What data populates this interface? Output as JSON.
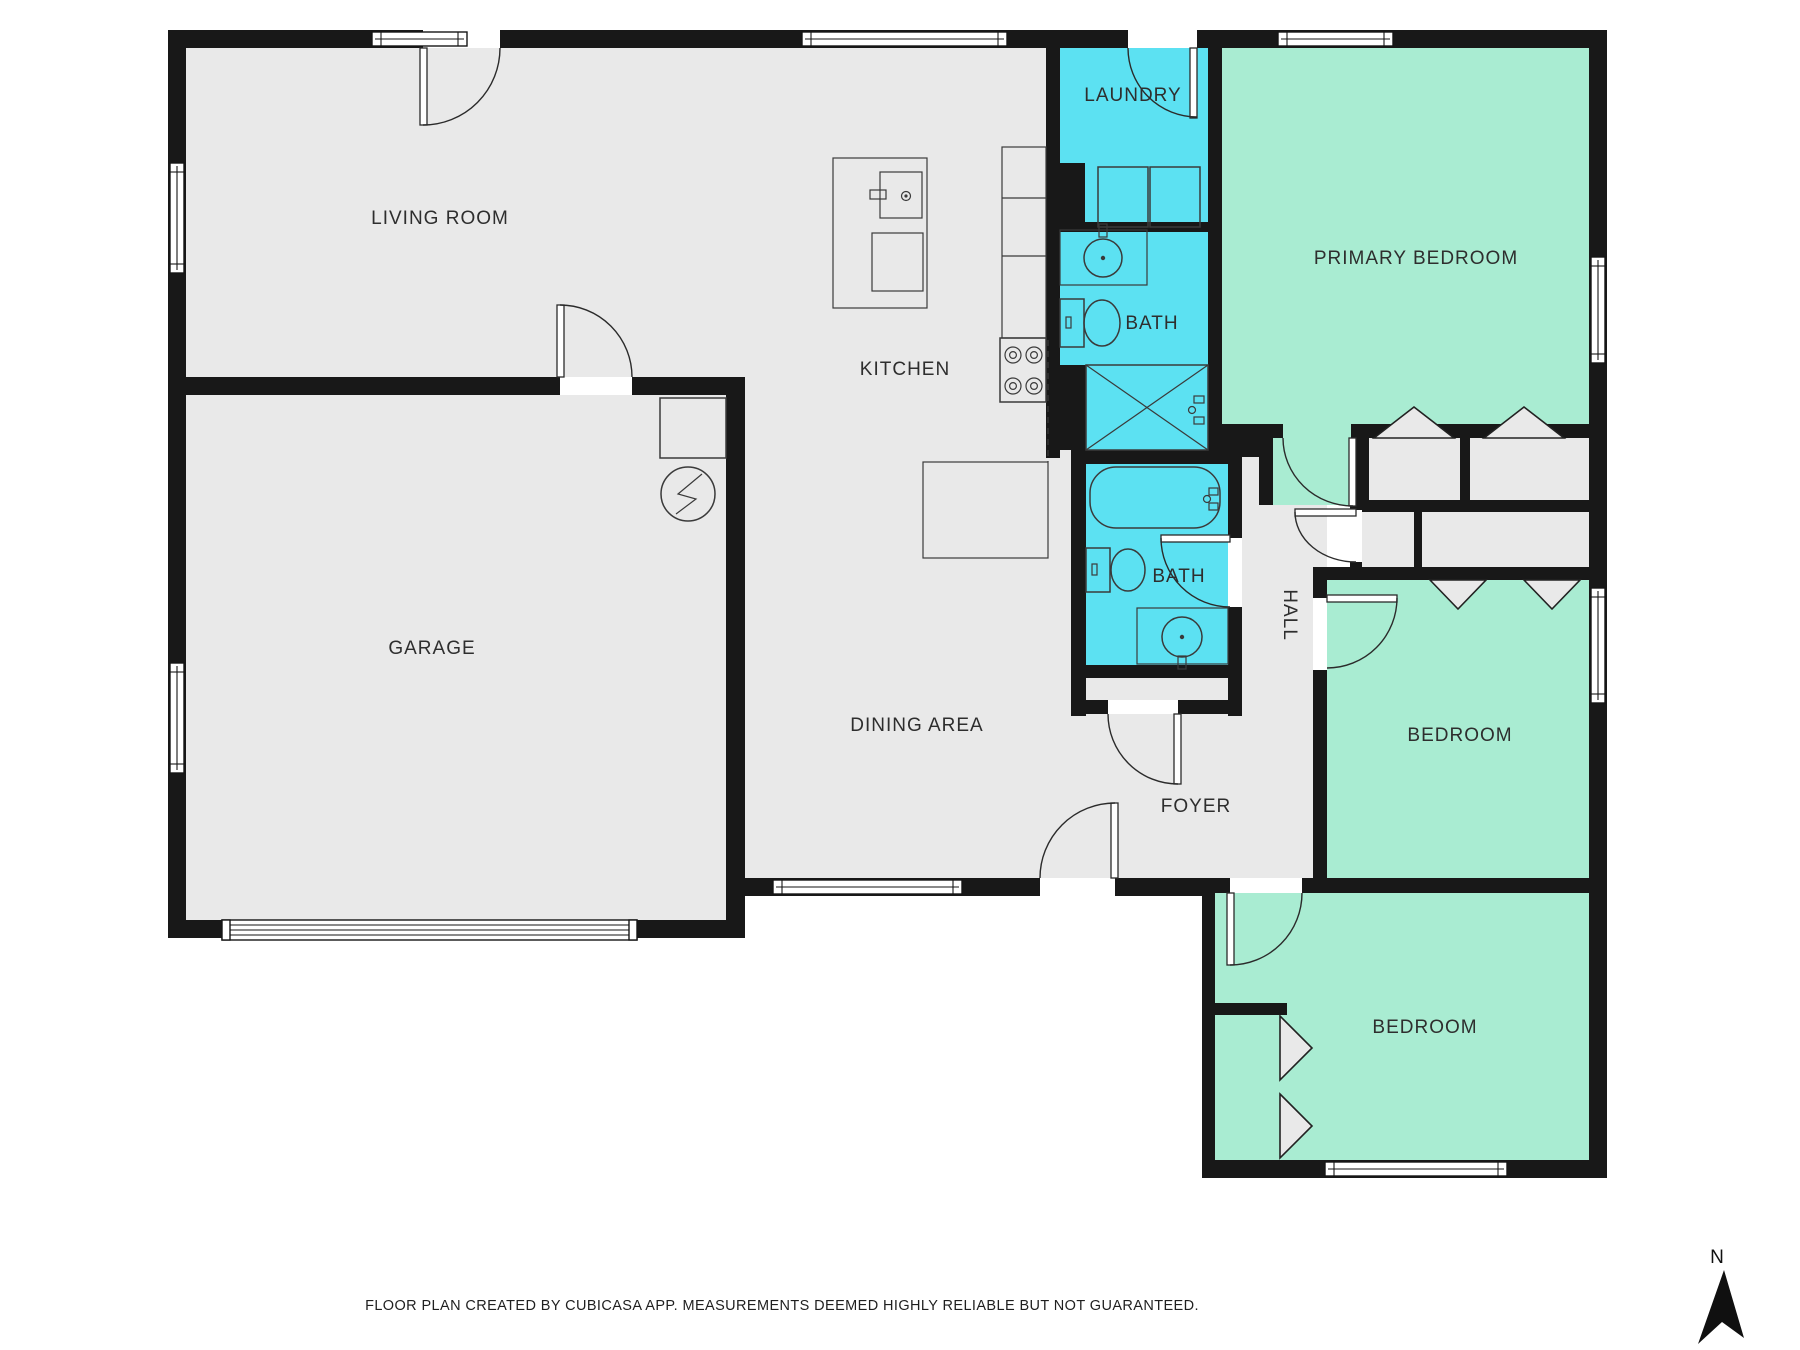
{
  "floorplan": {
    "rooms": [
      {
        "id": "living-room",
        "label": "LIVING ROOM"
      },
      {
        "id": "kitchen",
        "label": "KITCHEN"
      },
      {
        "id": "dining-area",
        "label": "DINING AREA"
      },
      {
        "id": "garage",
        "label": "GARAGE"
      },
      {
        "id": "laundry",
        "label": "LAUNDRY"
      },
      {
        "id": "bath-upper",
        "label": "BATH"
      },
      {
        "id": "bath-lower",
        "label": "BATH"
      },
      {
        "id": "hall",
        "label": "HALL"
      },
      {
        "id": "foyer",
        "label": "FOYER"
      },
      {
        "id": "primary-bedroom",
        "label": "PRIMARY BEDROOM"
      },
      {
        "id": "bedroom-middle",
        "label": "BEDROOM"
      },
      {
        "id": "bedroom-bottom",
        "label": "BEDROOM"
      }
    ],
    "colors": {
      "wall": "#181818",
      "floor_gray": "#e9e9e9",
      "wet_cyan": "#5ce1f2",
      "bedroom_green": "#a9ecd2"
    }
  },
  "footer": {
    "disclaimer": "FLOOR PLAN CREATED BY CUBICASA APP. MEASUREMENTS DEEMED HIGHLY RELIABLE BUT NOT GUARANTEED."
  },
  "compass": {
    "north_label": "N"
  }
}
